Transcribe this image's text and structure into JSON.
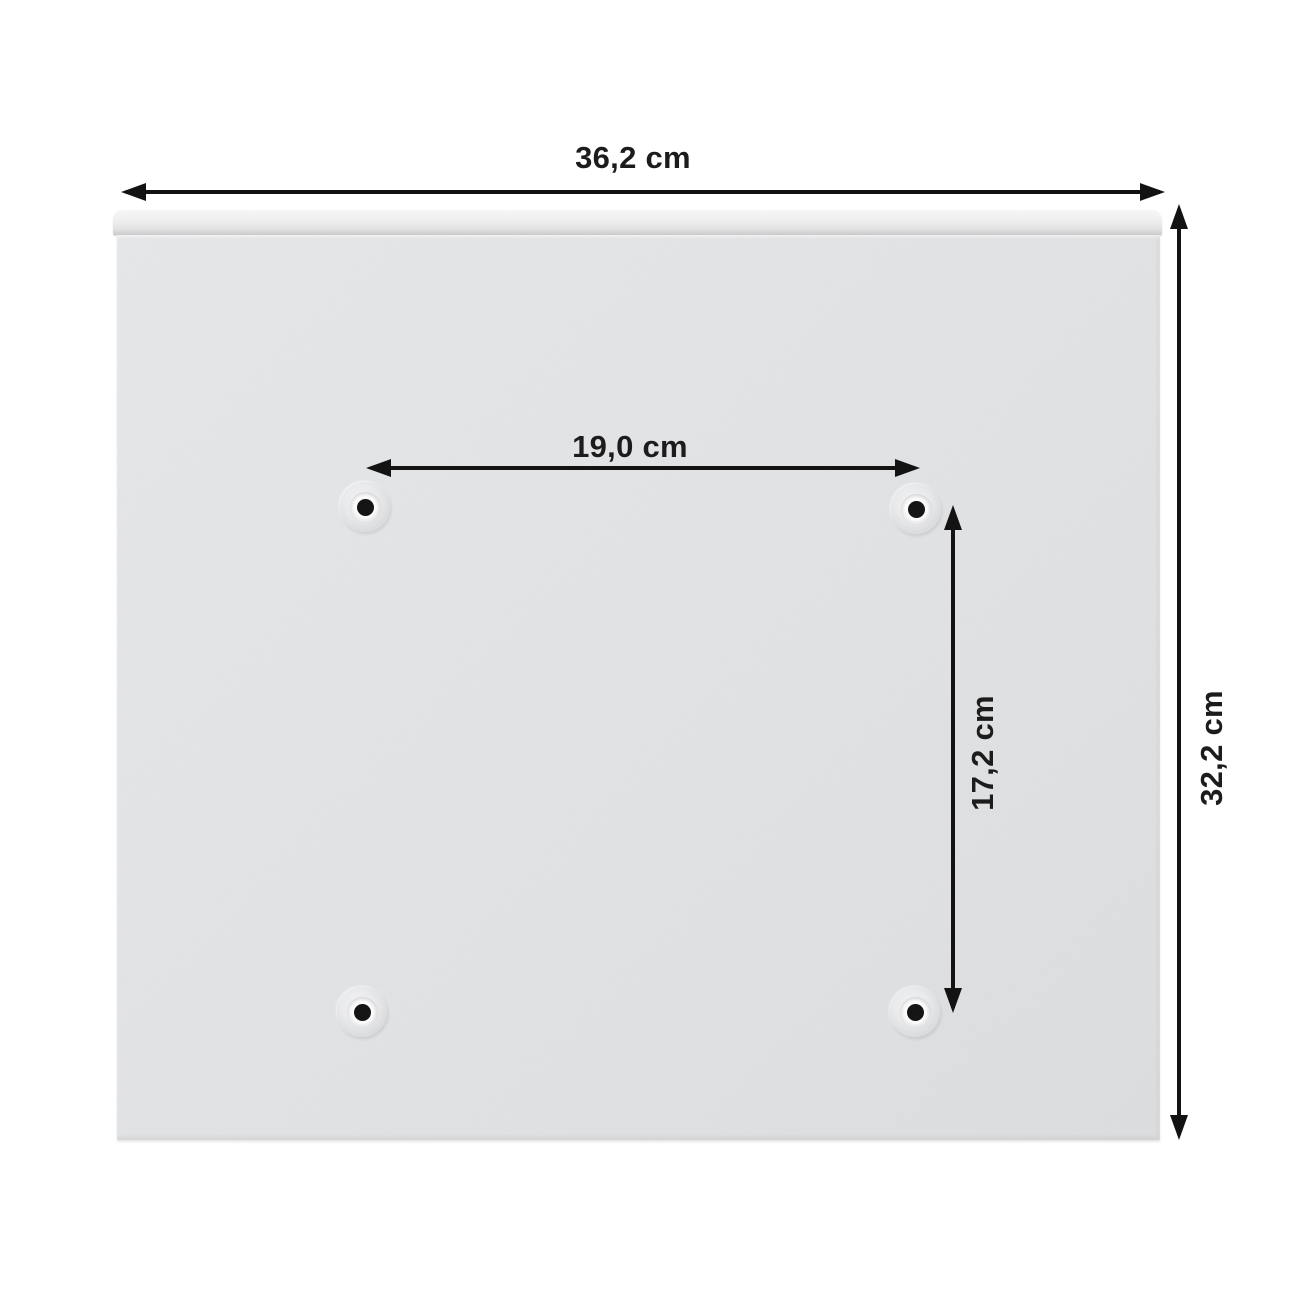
{
  "diagram": {
    "type": "product-dimension-drawing",
    "subject": "flat panel (back plate) with four mounting holes",
    "background_color": "#ffffff",
    "panel_color": "#e2e3e5",
    "annotation_color": "#131313",
    "hole_count": 4
  },
  "labels": {
    "width_total": "36,2 cm",
    "height_total": "32,2 cm",
    "hole_spacing_horizontal": "19,0 cm",
    "hole_spacing_vertical": "17,2 cm"
  },
  "measurements": [
    {
      "value": "36,2 cm",
      "orientation": "horizontal",
      "measures": "total width",
      "position": "top"
    },
    {
      "value": "32,2 cm",
      "orientation": "vertical",
      "measures": "total height",
      "position": "right"
    },
    {
      "value": "19,0 cm",
      "orientation": "horizontal",
      "measures": "horizontal distance between mounting holes",
      "position": "between top holes"
    },
    {
      "value": "17,2 cm",
      "orientation": "vertical",
      "measures": "vertical distance between mounting holes",
      "position": "between right holes"
    }
  ]
}
